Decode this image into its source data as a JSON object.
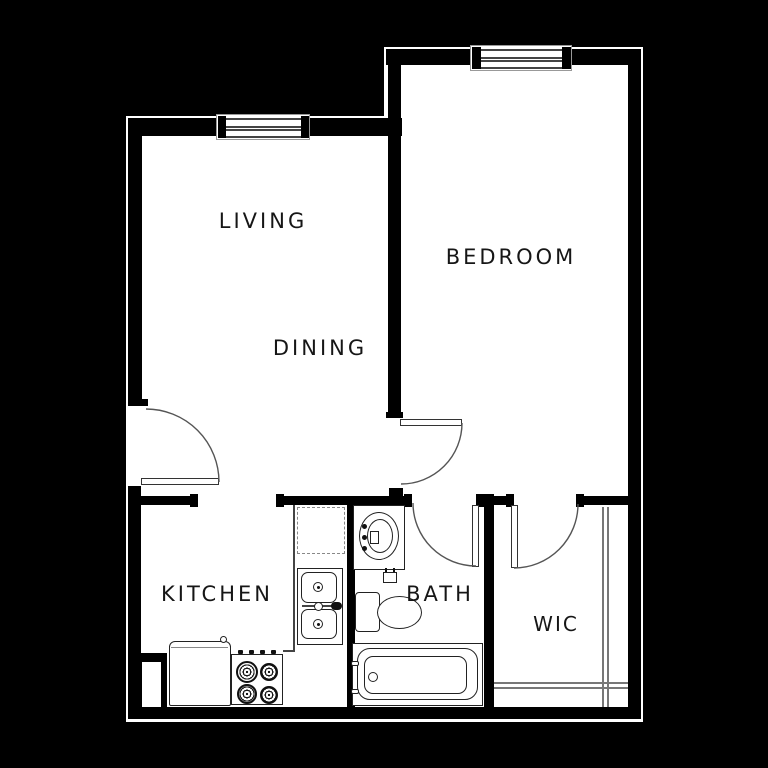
{
  "plan": {
    "kind": "apartment-floor-plan",
    "style": "black-and-white architectural drawing",
    "colors": {
      "background": "#000000",
      "walls": "#000000",
      "floor": "#ffffff",
      "linework": "#444444"
    }
  },
  "rooms": {
    "living": {
      "label": "LIVING"
    },
    "dining": {
      "label": "DINING"
    },
    "bedroom": {
      "label": "BEDROOM"
    },
    "kitchen": {
      "label": "KITCHEN"
    },
    "bath": {
      "label": "BATH"
    },
    "wic": {
      "label": "WIC"
    }
  },
  "features": {
    "windows": [
      "living-window",
      "bedroom-window"
    ],
    "doors": [
      "entry-door",
      "bedroom-door",
      "bath-door",
      "wic-door"
    ],
    "kitchen_fixtures": [
      "refrigerator",
      "range-stove",
      "double-sink",
      "counter",
      "upper-cabinets-dashed"
    ],
    "bath_fixtures": [
      "vanity-sink",
      "toilet",
      "bathtub"
    ],
    "wic_fixtures": [
      "closet-shelf-lines"
    ]
  }
}
